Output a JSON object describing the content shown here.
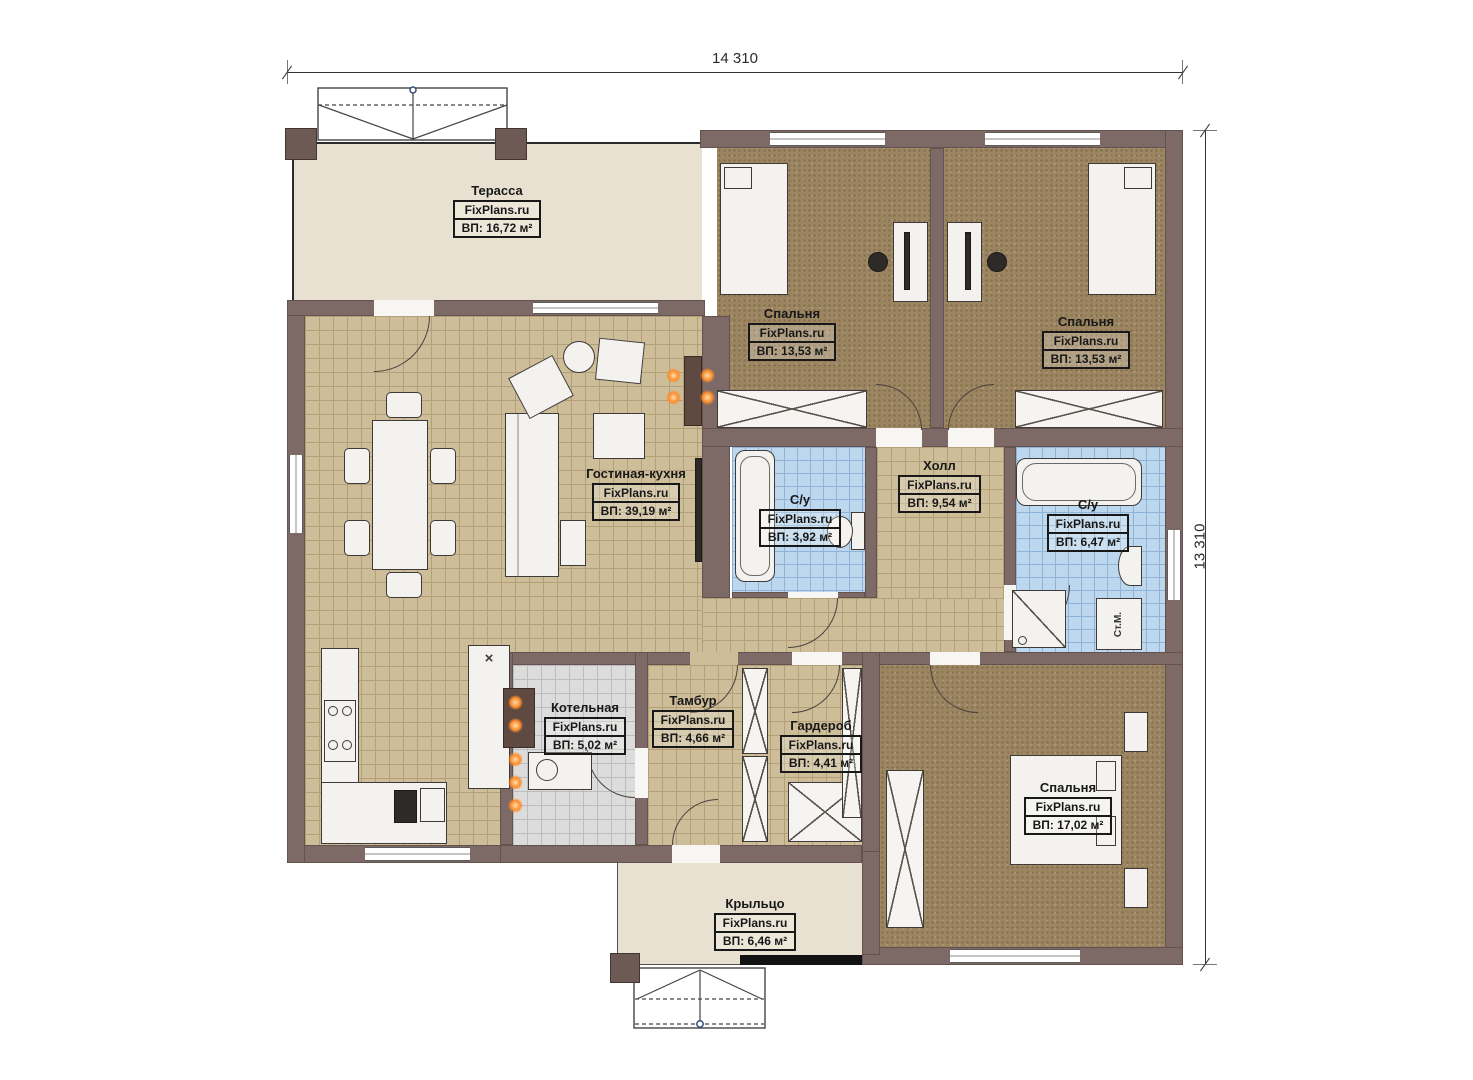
{
  "plan": {
    "dimensions": {
      "width_mm": "14 310",
      "height_mm": "13 310"
    },
    "watermark": "FixPlans.ru",
    "rooms": {
      "terrace": {
        "name": "Терасса",
        "area": "ВП: 16,72 м²"
      },
      "bedroom1": {
        "name": "Спальня",
        "area": "ВП: 13,53 м²"
      },
      "bedroom2": {
        "name": "Спальня",
        "area": "ВП: 13,53 м²"
      },
      "living": {
        "name": "Гостиная-кухня",
        "area": "ВП: 39,19 м²"
      },
      "bath1": {
        "name": "С/у",
        "area": "ВП: 3,92 м²"
      },
      "hall": {
        "name": "Холл",
        "area": "ВП: 9,54 м²"
      },
      "bath2": {
        "name": "С/у",
        "area": "ВП: 6,47 м²"
      },
      "boiler": {
        "name": "Котельная",
        "area": "ВП: 5,02 м²"
      },
      "tambour": {
        "name": "Тамбур",
        "area": "ВП: 4,66 м²"
      },
      "wardrobe": {
        "name": "Гардероб",
        "area": "ВП: 4,41 м²"
      },
      "bedroom3": {
        "name": "Спальня",
        "area": "ВП: 17,02 м²"
      },
      "porch": {
        "name": "Крыльцо",
        "area": "ВП: 6,46 м²"
      }
    },
    "appliances": {
      "washing_machine": "Ст.М."
    },
    "markers": {
      "kitchen_x": "×"
    },
    "colors": {
      "wall": "#7d6a66",
      "floor_beige": "#e8e0d1",
      "floor_tile_tan": "#cdbd98",
      "floor_tile_blue": "#bcd7ee",
      "floor_tile_gray": "#dcdcdc",
      "carpet_brown": "#9c8561",
      "heat_orange": "#ff8c2a",
      "line_dark": "#3f3a38"
    }
  }
}
